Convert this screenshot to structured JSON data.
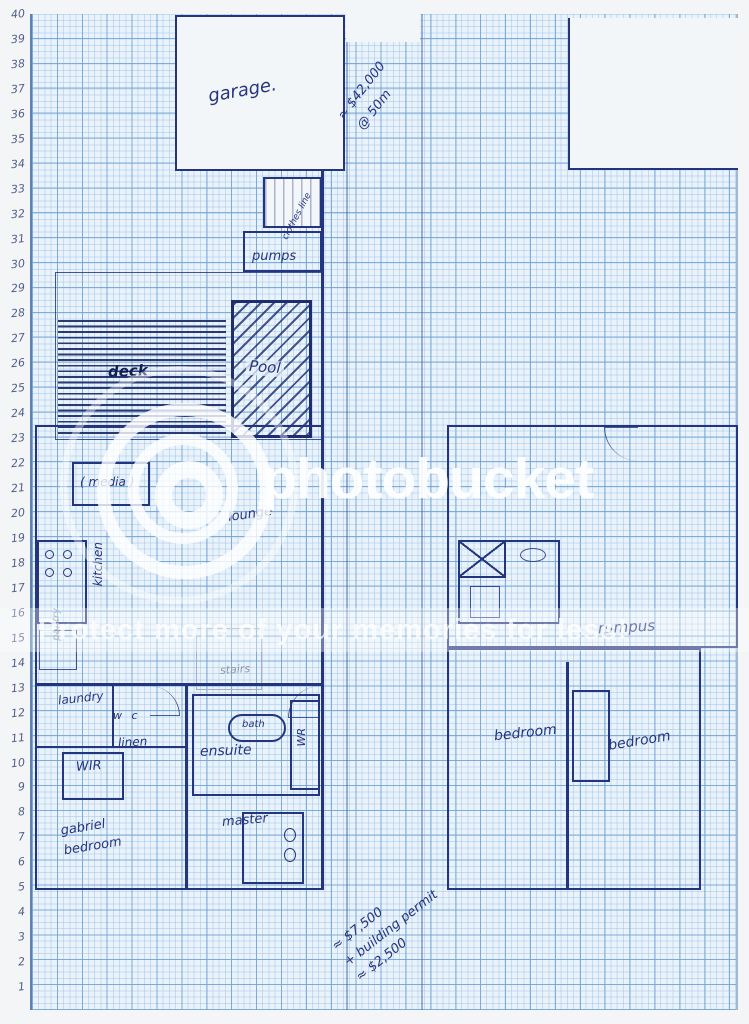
{
  "ruler": {
    "numbers": [
      40,
      39,
      38,
      37,
      36,
      35,
      34,
      33,
      32,
      31,
      30,
      29,
      28,
      27,
      26,
      25,
      24,
      23,
      22,
      21,
      20,
      19,
      18,
      17,
      16,
      15,
      14,
      13,
      12,
      11,
      10,
      9,
      8,
      7,
      6,
      5,
      4,
      3,
      2,
      1
    ]
  },
  "rooms": {
    "garage": "garage.",
    "clothes_line": "clothes line",
    "pumps": "pumps",
    "deck": "deck",
    "pool": "Pool",
    "media": "( media )",
    "lounge": "lounge",
    "kitchen": "kitchen",
    "pantry": "pantry",
    "stairs": "stairs",
    "laundry": "laundry",
    "wc": "w c",
    "linen": "linen",
    "wir": "WIR",
    "ensuite": "ensuite",
    "bath": "bath",
    "wir_master": "WR",
    "master": "master",
    "child_bedroom_line1": "gabriel",
    "child_bedroom_line2": "bedroom",
    "bedroom_left": "bedroom",
    "bedroom_right": "bedroom",
    "rumpus": "rumpus"
  },
  "notes": {
    "cost_top_line1": "≈ $42,000",
    "cost_top_line2": "@ 50m",
    "cost_bottom_line1": "≈ $7,500",
    "cost_bottom_line2": "+ building permit",
    "cost_bottom_line3": "≈ $2,500"
  },
  "watermark": {
    "brand": "photobucket",
    "tagline": "Protect more of your memories for less!"
  },
  "colors": {
    "paper": "#eaf3fb",
    "grid_minor": "#9fc3e4",
    "grid_major": "#6fa3d4",
    "ink": "#24357f",
    "pencil": "#8d97ab",
    "margin": "#f3f5f6",
    "watermark_white": "#ffffff"
  }
}
